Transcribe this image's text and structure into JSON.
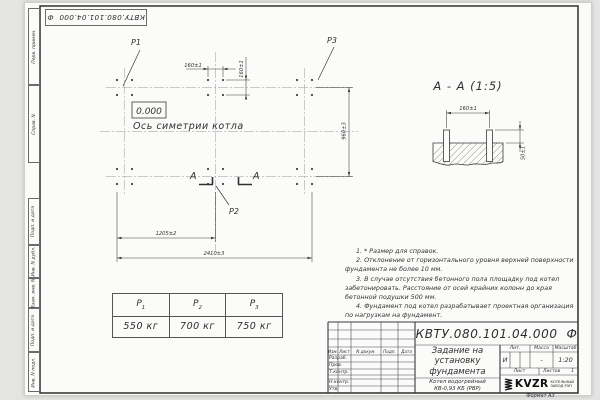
{
  "frame": {
    "doc_number_flipped": "КВТУ.080.101.04.000  Ф",
    "side_labels": [
      "Перв. примен.",
      "Справ. N",
      "Подп. и дата",
      "Инв. N дубл.",
      "Взам. инв. N",
      "Подп. и дата",
      "Инв. N подл."
    ],
    "format_note": "Формат А3"
  },
  "plan": {
    "points": {
      "p1": "P1",
      "p2": "P2",
      "p3": "P3"
    },
    "elevation_mark": "0.000",
    "axis_label": "Ось симетрии котла",
    "section_letter": "А",
    "dims": {
      "bolt_spacing_x": "160±1",
      "bolt_spacing_y": "160±1",
      "row_spacing": "960±3",
      "half_length": "1205±2",
      "full_length": "2410±3"
    }
  },
  "section_view": {
    "title": "А - А (1:5)",
    "dims": {
      "bolt_spacing": "160±1",
      "protrusion": "50±1"
    }
  },
  "notes": [
    "1. * Размер для справок.",
    "2. Отклонение от горизонтального уровня верхней поверхности фундамента не более 10 мм.",
    "3. В случае отсутствия бетонного пола площадку под котел забетонировать. Расстояние от осей крайних колонн до края бетонной подушки 500 мм.",
    "4. Фундамент под котел разрабатывает проектная организация по нагрузкам на фундамент."
  ],
  "load_table": {
    "headers": [
      {
        "base": "P",
        "sub": "1"
      },
      {
        "base": "P",
        "sub": "2"
      },
      {
        "base": "P",
        "sub": "3"
      }
    ],
    "values": [
      "550 кг",
      "700 кг",
      "750 кг"
    ]
  },
  "title_block": {
    "doc_number": "КВТУ.080.101.04.000  Ф",
    "title_lines": [
      "Задание на",
      "установку",
      "фундамента"
    ],
    "columns": {
      "izm": "Изм.",
      "list": "Лист",
      "doc": "N докум.",
      "sign": "Подп.",
      "date": "Дата"
    },
    "rows": [
      "Разраб.",
      "Пров.",
      "Т.контр.",
      "Н.контр.",
      "Утв."
    ],
    "lit_header": "Лит.",
    "mass_header": "Масса",
    "scale_header": "Масштаб",
    "lit_value": "И",
    "mass_value": "-",
    "scale_value": "1:20",
    "sheet_label": "Лист",
    "sheets_label": "Листов",
    "sheets_value": "1",
    "product_lines": [
      "Котел водогрейный",
      "КВ-0,93 КБ (РВР)"
    ],
    "company": {
      "name": "KVZR",
      "sub1": "КОТЕЛЬНЫЙ",
      "sub2": "ЗАВОД РЭП"
    }
  }
}
